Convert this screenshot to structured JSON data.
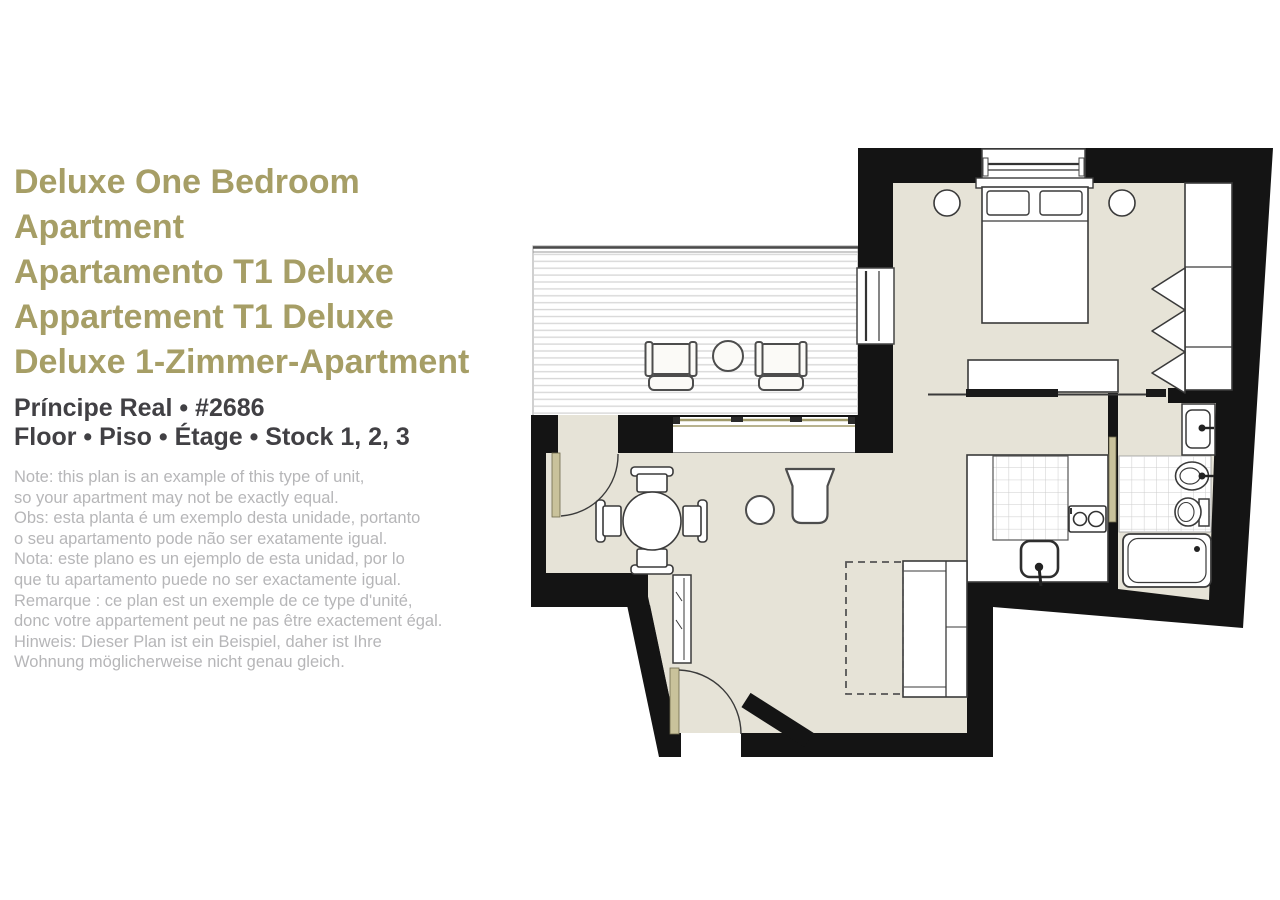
{
  "title": {
    "lines": [
      "Deluxe One Bedroom Apartment",
      "Apartamento T1 Deluxe",
      "Appartement T1 Deluxe",
      "Deluxe 1-Zimmer-Apartment"
    ]
  },
  "location": {
    "line1": "Príncipe Real  •  #2686",
    "line2": "Floor  •  Piso  •  Étage  •  Stock 1, 2, 3"
  },
  "note": {
    "lines": [
      "Note: this plan is an example of this type of unit,",
      "so your apartment may not be exactly equal.",
      "Obs: esta planta é um exemplo desta unidade, portanto",
      "o seu apartamento pode não ser exatamente igual.",
      "Nota: este plano es un ejemplo de esta unidad, por lo",
      "que tu apartamento puede no ser exactamente igual.",
      "Remarque : ce plan est un exemple de ce type d'unité,",
      "donc votre appartement peut ne pas être exactement égal.",
      "Hinweis: Dieser Plan ist ein Beispiel, daher ist Ihre",
      "Wohnung möglicherweise nicht genau gleich."
    ]
  },
  "colors": {
    "title_olive": "#a69e66",
    "heading_dark": "#414044",
    "note_gray": "#b6b6b8",
    "wall_black": "#141414",
    "floor_beige": "#e6e3d7",
    "door_tan": "#c9c29b",
    "deck_stripe": "#d8d8d8",
    "tile_line": "#cccccc",
    "furniture_stroke": "#3a3a3a"
  },
  "floorplan": {
    "rooms": [
      "bedroom",
      "living-dining-room",
      "kitchen",
      "bathroom",
      "terrace",
      "entry"
    ],
    "fixtures": [
      "double-bed",
      "bedside-tables",
      "wardrobe",
      "dresser",
      "sliding-door-rail",
      "terrace-armchairs",
      "terrace-coffee-table",
      "dining-table-with-four-chairs",
      "tub-armchair",
      "side-table",
      "sofa",
      "sofa-bed-extension",
      "entry-mirror",
      "kitchen-sink",
      "cooktop",
      "washbasin",
      "bidet",
      "toilet",
      "bathtub"
    ]
  }
}
